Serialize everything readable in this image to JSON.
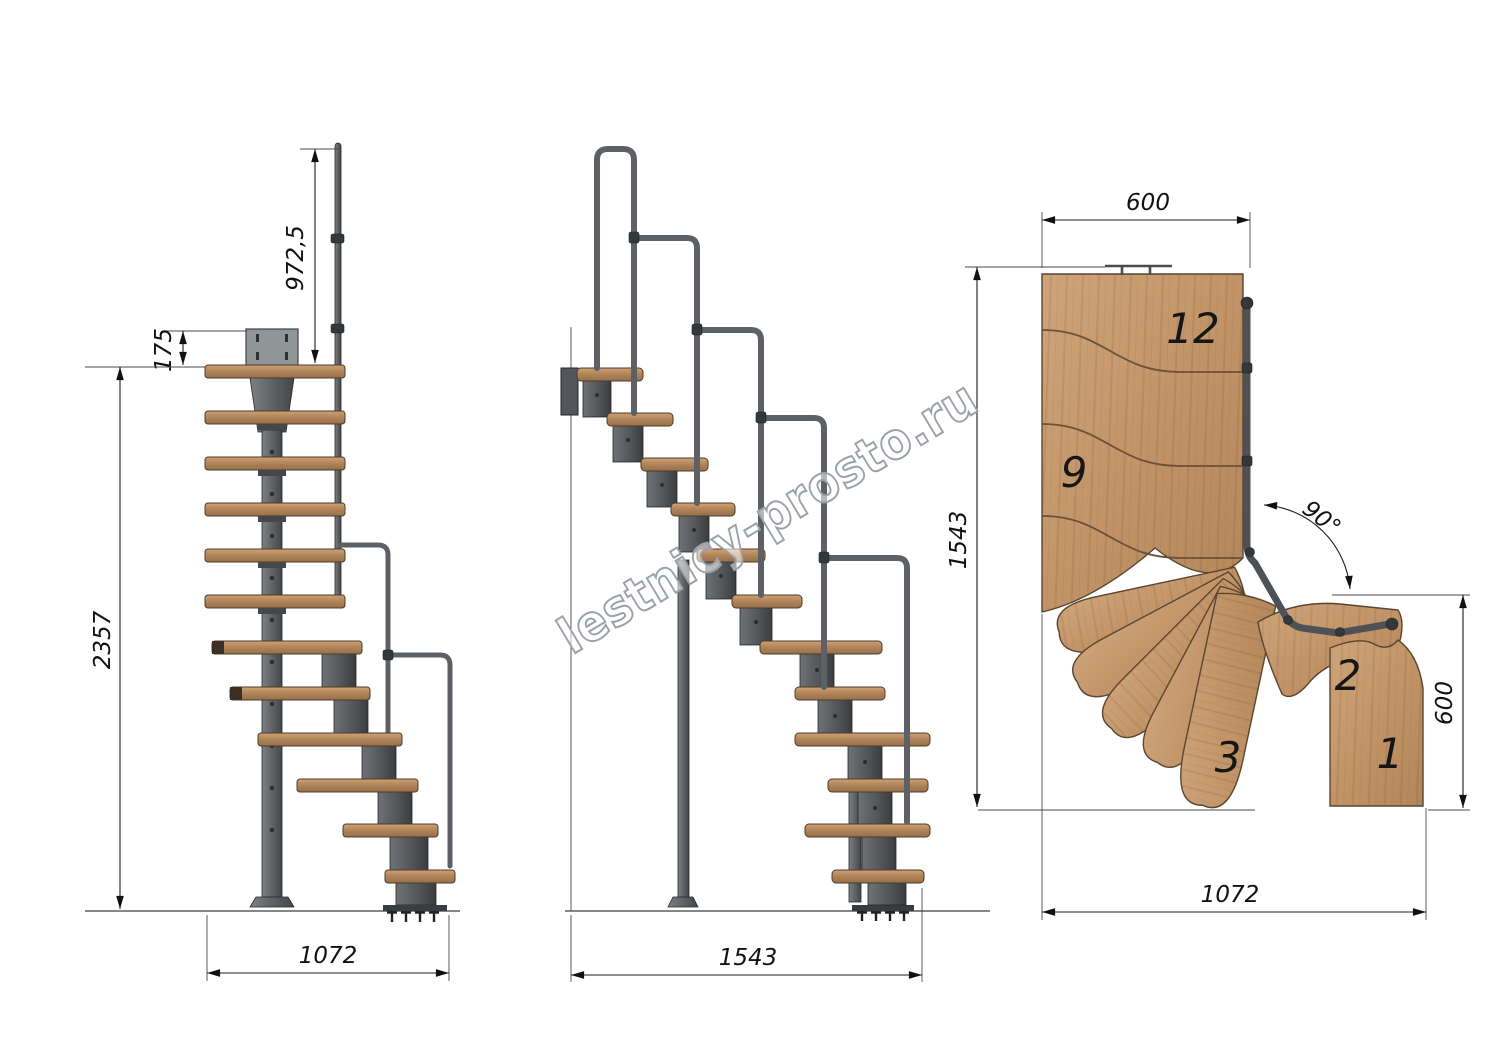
{
  "drawing": {
    "watermark": "lestnicy-prosto.ru",
    "side_view": {
      "dim_handrail_height": "972,5",
      "dim_bracket_height": "175",
      "dim_total_height": "2357",
      "dim_run": "1072"
    },
    "front_view": {
      "dim_run": "1543"
    },
    "plan_view": {
      "dim_top_width": "600",
      "dim_length": "1543",
      "dim_turn_angle": "90°",
      "dim_exit_width": "600",
      "dim_run": "1072",
      "step_numbers": {
        "s12": "12",
        "s9": "9",
        "s3": "3",
        "s2": "2",
        "s1": "1"
      }
    },
    "colors": {
      "wood": "#c49b6d",
      "wood_dark": "#9c7248",
      "metal": "#6b6f73",
      "metal_dark": "#3f4245",
      "dimension_line": "#1c1c1c",
      "watermark_outline": "#9ca1a8"
    }
  }
}
